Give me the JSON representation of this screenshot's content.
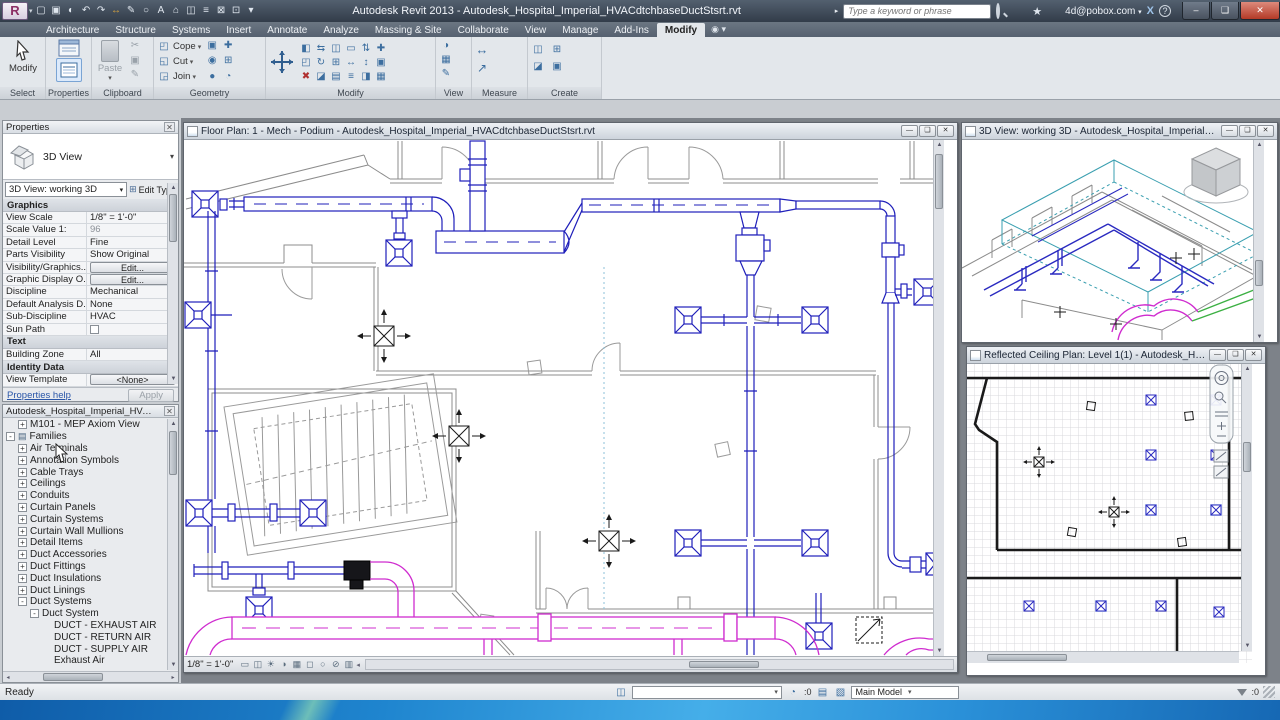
{
  "app": {
    "title": "Autodesk Revit 2013 - Autodesk_Hospital_Imperial_HVACdtchbaseDuctStsrt.rvt",
    "logo_letter": "R",
    "window_buttons": {
      "minimize": "–",
      "maximize": "❑",
      "close": "✕"
    }
  },
  "qat": {
    "icons": [
      "▢",
      "▣",
      "◐",
      "↶",
      "↷",
      {
        "g": "↔",
        "c": "#d9a33c"
      },
      "✎",
      "○",
      "A",
      "⌂",
      "◫",
      "≡",
      "⊠",
      "⊡",
      "▾"
    ]
  },
  "info_center": {
    "search_placeholder": "Type a keyword or phrase",
    "account": "4d@pobox.com",
    "star_icon": "★",
    "exchange_icon": "X",
    "help_icon": "?",
    "caret": "▾"
  },
  "ribbon": {
    "tabs": [
      {
        "label": "Architecture",
        "active": false
      },
      {
        "label": "Structure",
        "active": false
      },
      {
        "label": "Systems",
        "active": false
      },
      {
        "label": "Insert",
        "active": false
      },
      {
        "label": "Annotate",
        "active": false
      },
      {
        "label": "Analyze",
        "active": false
      },
      {
        "label": "Massing & Site",
        "active": false
      },
      {
        "label": "Collaborate",
        "active": false
      },
      {
        "label": "View",
        "active": false
      },
      {
        "label": "Manage",
        "active": false
      },
      {
        "label": "Add-Ins",
        "active": false
      },
      {
        "label": "Modify",
        "active": true
      }
    ],
    "tab_extra": "◉ ▾",
    "panels": {
      "select": {
        "label": "Select",
        "modify_button": "Modify"
      },
      "properties": {
        "label": "Properties"
      },
      "clipboard": {
        "label": "Clipboard",
        "paste_button": "Paste",
        "icons": [
          "✂",
          "▣",
          "✎"
        ]
      },
      "geometry": {
        "label": "Geometry",
        "buttons": [
          "Cope",
          "Cut",
          "Join"
        ],
        "icons": [
          "◰",
          "◱",
          "◲"
        ],
        "side": [
          "▣",
          "✚",
          "◉",
          "⊞",
          "●",
          "◔"
        ]
      },
      "modify": {
        "label": "Modify",
        "icons": [
          "◧",
          "⇆",
          "◫",
          "▭",
          "⇅",
          "✚",
          "◰",
          "↻",
          "⊞",
          "↔",
          "↕",
          "▣",
          {
            "g": "✖",
            "c": "#b03030"
          },
          "◪",
          "▤",
          "≡",
          "◨",
          "▦"
        ]
      },
      "view": {
        "label": "View",
        "icons": [
          "◑",
          "▦",
          "✎"
        ]
      },
      "measure": {
        "label": "Measure",
        "icons": [
          {
            "g": "↔",
            "c": "#d9a33c"
          },
          "↗"
        ]
      },
      "create": {
        "label": "Create",
        "icons": [
          "◫",
          "⊞",
          "◪",
          "▣"
        ]
      }
    }
  },
  "properties_palette": {
    "title": "Properties",
    "type_selector": "3D View",
    "instance_selector": "3D View: working 3D",
    "edit_type": "Edit Type",
    "edit_type_icon": "⊞",
    "rows": [
      {
        "kind": "section",
        "label": "Graphics"
      },
      {
        "kind": "text",
        "label": "View Scale",
        "value": "1/8\" = 1'-0\""
      },
      {
        "kind": "text",
        "label": "Scale Value    1:",
        "value": "96",
        "dim": true
      },
      {
        "kind": "text",
        "label": "Detail Level",
        "value": "Fine"
      },
      {
        "kind": "text",
        "label": "Parts Visibility",
        "value": "Show Original"
      },
      {
        "kind": "button",
        "label": "Visibility/Graphics...",
        "value": "Edit..."
      },
      {
        "kind": "button",
        "label": "Graphic Display O...",
        "value": "Edit..."
      },
      {
        "kind": "text",
        "label": "Discipline",
        "value": "Mechanical"
      },
      {
        "kind": "text",
        "label": "Default Analysis D...",
        "value": "None"
      },
      {
        "kind": "text",
        "label": "Sub-Discipline",
        "value": "HVAC"
      },
      {
        "kind": "checkbox",
        "label": "Sun Path",
        "value": ""
      },
      {
        "kind": "section",
        "label": "Text"
      },
      {
        "kind": "text",
        "label": "Building Zone",
        "value": "All"
      },
      {
        "kind": "section",
        "label": "Identity Data"
      },
      {
        "kind": "button",
        "label": "View Template",
        "value": "<None>"
      }
    ],
    "help_link": "Properties help",
    "apply_button": "Apply"
  },
  "project_browser": {
    "title": "Autodesk_Hospital_Imperial_HVACdtchbas...",
    "items": [
      {
        "label": "M101 - MEP Axiom View",
        "depth": 1,
        "state": "+"
      },
      {
        "label": "Families",
        "depth": 0,
        "state": "-",
        "icon": "▤"
      },
      {
        "label": "Air Terminals",
        "depth": 1,
        "state": "+"
      },
      {
        "label": "Annotation Symbols",
        "depth": 1,
        "state": "+"
      },
      {
        "label": "Cable Trays",
        "depth": 1,
        "state": "+"
      },
      {
        "label": "Ceilings",
        "depth": 1,
        "state": "+"
      },
      {
        "label": "Conduits",
        "depth": 1,
        "state": "+"
      },
      {
        "label": "Curtain Panels",
        "depth": 1,
        "state": "+"
      },
      {
        "label": "Curtain Systems",
        "depth": 1,
        "state": "+"
      },
      {
        "label": "Curtain Wall Mullions",
        "depth": 1,
        "state": "+"
      },
      {
        "label": "Detail Items",
        "depth": 1,
        "state": "+"
      },
      {
        "label": "Duct Accessories",
        "depth": 1,
        "state": "+"
      },
      {
        "label": "Duct Fittings",
        "depth": 1,
        "state": "+"
      },
      {
        "label": "Duct Insulations",
        "depth": 1,
        "state": "+"
      },
      {
        "label": "Duct Linings",
        "depth": 1,
        "state": "+"
      },
      {
        "label": "Duct Systems",
        "depth": 1,
        "state": "-"
      },
      {
        "label": "Duct System",
        "depth": 2,
        "state": "-"
      },
      {
        "label": "DUCT - EXHAUST AIR",
        "depth": 3,
        "state": ""
      },
      {
        "label": "DUCT - RETURN AIR",
        "depth": 3,
        "state": ""
      },
      {
        "label": "DUCT - SUPPLY AIR",
        "depth": 3,
        "state": ""
      },
      {
        "label": "Exhaust Air",
        "depth": 3,
        "state": ""
      }
    ]
  },
  "windows": {
    "floor_plan": {
      "title": "Floor Plan: 1 - Mech - Podium - Autodesk_Hospital_Imperial_HVACdtchbaseDuctStsrt.rvt",
      "scale": "1/8\" = 1'-0\"",
      "viewbar_icons": [
        "▭",
        "◫",
        "☀",
        "◑",
        "▦",
        "◻",
        "○",
        "⊘",
        "▥"
      ]
    },
    "three_d": {
      "title": "3D View: working 3D - Autodesk_Hospital_Imperial_HVACdtc..."
    },
    "rcp": {
      "title": "Reflected Ceiling Plan: Level 1(1) - Autodesk_Hospital_I..."
    }
  },
  "status_bar": {
    "ready": "Ready",
    "main_model": "Main Model",
    "editable_count": "0",
    "filter_count": "0",
    "icons": [
      "◫",
      "◔",
      "▤",
      "▧"
    ]
  }
}
